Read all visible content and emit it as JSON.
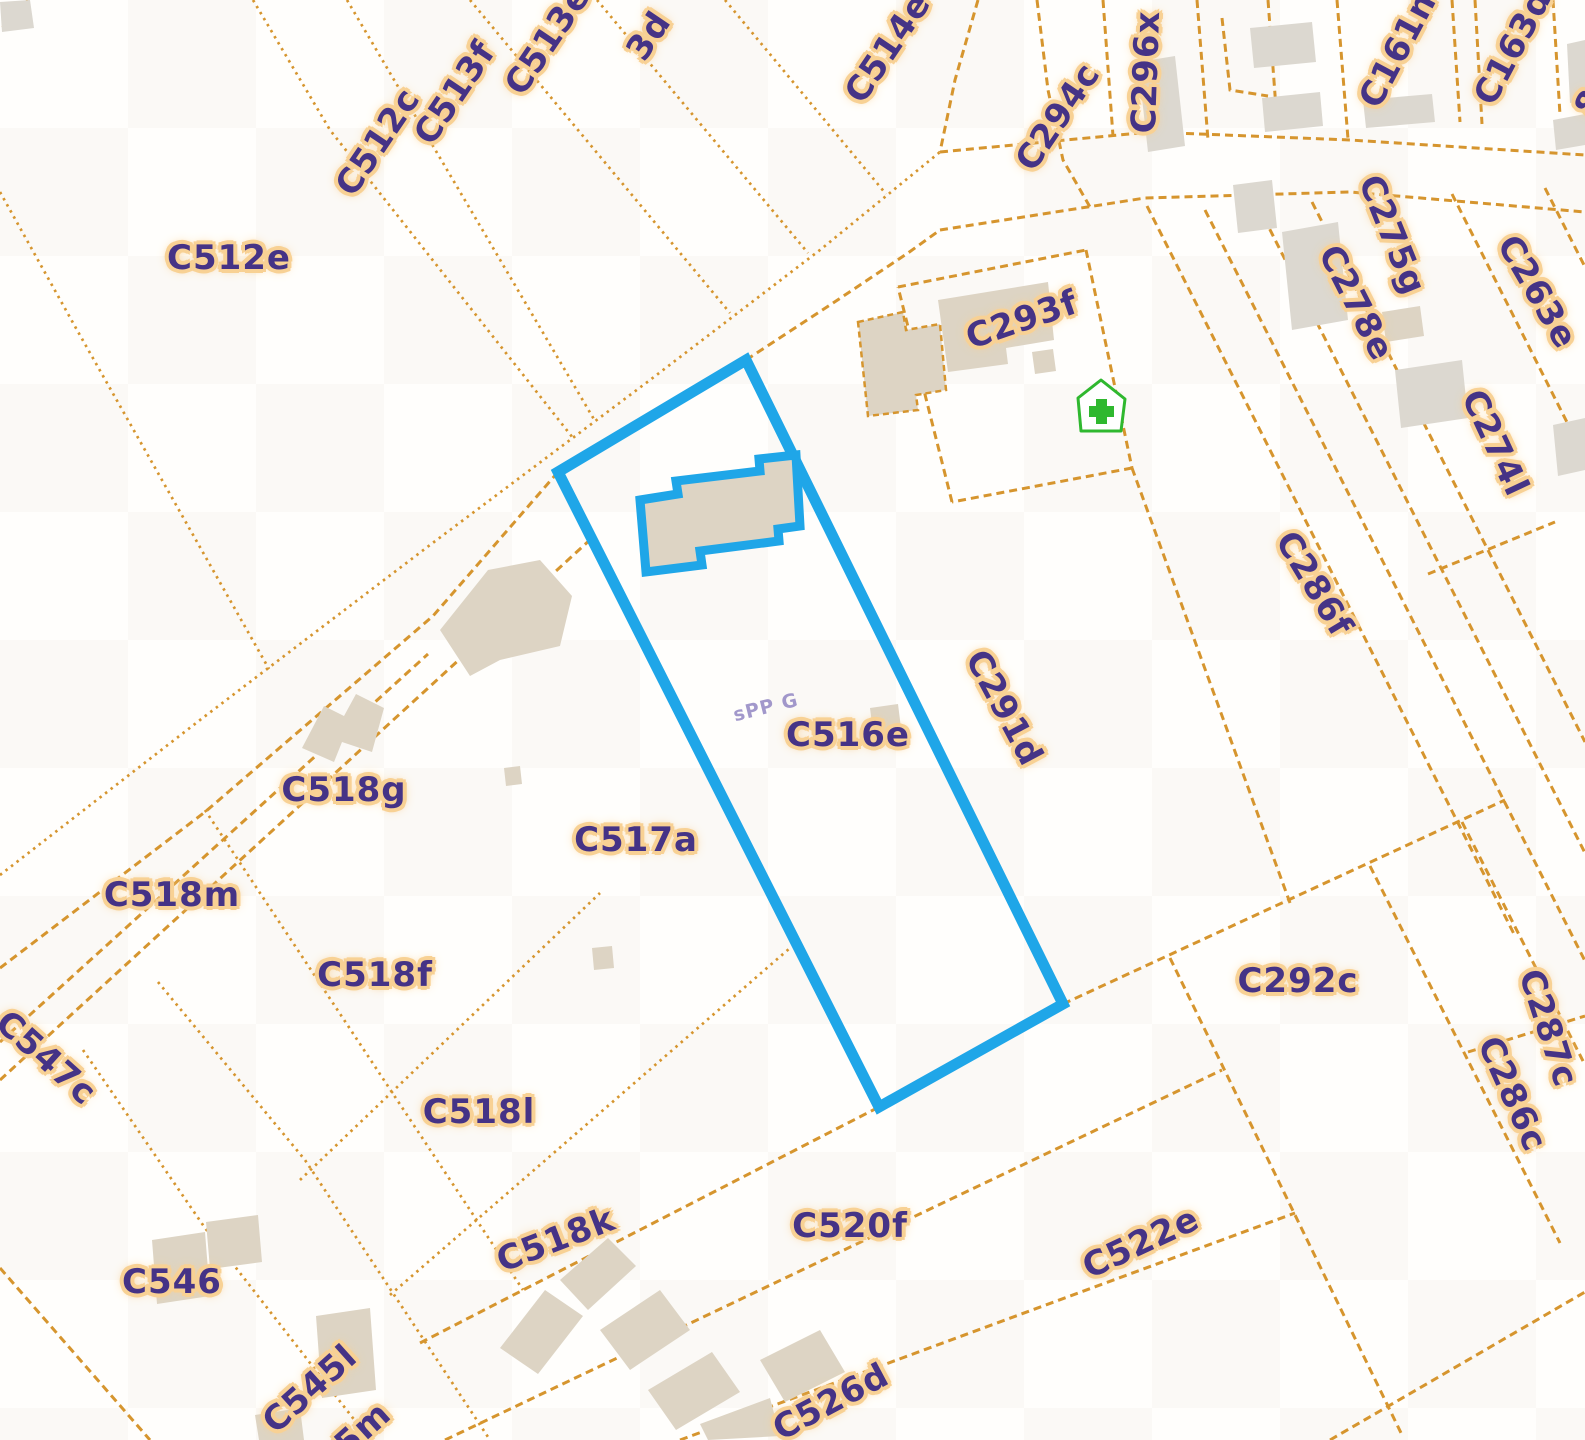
{
  "map": {
    "type": "cadastral-parcel-map",
    "canvas": {
      "width": 1585,
      "height": 1440
    },
    "colors": {
      "background": "#fffefc",
      "parcel_line": "#d6952e",
      "label_text": "#453386",
      "label_halo": "#f8d194",
      "highlight_blue": "#1fa6e8",
      "building_fill": "#ddd4c4",
      "building_fill_alt": "#dcd8d0",
      "poi_green": "#2fb82f",
      "faint_text": "#8b7fc0"
    },
    "selected_parcel": {
      "label": "C516e",
      "outline_points": "558,472 746,360 1063,1004 879,1107",
      "building_points": "640,500 678,494 676,481 760,471 759,459 796,455 800,526 778,529 779,541 700,551 702,565 646,572"
    },
    "poi_icon": {
      "name": "pharmacy-house-icon",
      "house_points": "1101,380 1125,399 1121,431 1081,431 1078,398",
      "cross_v": {
        "x": 1096,
        "y": 399,
        "w": 11,
        "h": 25
      },
      "cross_h": {
        "x": 1089,
        "y": 406,
        "w": 25,
        "h": 11
      }
    },
    "labels": [
      {
        "text": "C512e",
        "x": 229,
        "y": 258,
        "rot": 0
      },
      {
        "text": "C512c",
        "x": 378,
        "y": 142,
        "rot": -56
      },
      {
        "text": "C513f",
        "x": 455,
        "y": 93,
        "rot": -56
      },
      {
        "text": "C513e",
        "x": 548,
        "y": 40,
        "rot": -56
      },
      {
        "text": "3d",
        "x": 649,
        "y": 36,
        "rot": -56
      },
      {
        "text": "C514e",
        "x": 888,
        "y": 48,
        "rot": -56
      },
      {
        "text": "C294c",
        "x": 1058,
        "y": 117,
        "rot": -56
      },
      {
        "text": "C296x",
        "x": 1146,
        "y": 72,
        "rot": -88
      },
      {
        "text": "C161n",
        "x": 1398,
        "y": 50,
        "rot": -62
      },
      {
        "text": "C163d",
        "x": 1513,
        "y": 47,
        "rot": -62
      },
      {
        "text": "8",
        "x": 1590,
        "y": 103,
        "rot": -62
      },
      {
        "text": "C293f",
        "x": 1022,
        "y": 320,
        "rot": -19
      },
      {
        "text": "C275g",
        "x": 1392,
        "y": 235,
        "rot": 68
      },
      {
        "text": "C278e",
        "x": 1356,
        "y": 303,
        "rot": 63
      },
      {
        "text": "C263e",
        "x": 1537,
        "y": 292,
        "rot": 60
      },
      {
        "text": "C274l",
        "x": 1495,
        "y": 443,
        "rot": 65
      },
      {
        "text": "C286f",
        "x": 1314,
        "y": 584,
        "rot": 59
      },
      {
        "text": "C291d",
        "x": 1004,
        "y": 708,
        "rot": 62
      },
      {
        "text": "C516e",
        "x": 848,
        "y": 735,
        "rot": 0
      },
      {
        "text": "C517a",
        "x": 636,
        "y": 840,
        "rot": 0
      },
      {
        "text": "C518g",
        "x": 344,
        "y": 790,
        "rot": 0
      },
      {
        "text": "C518m",
        "x": 172,
        "y": 895,
        "rot": 0
      },
      {
        "text": "C518f",
        "x": 375,
        "y": 975,
        "rot": 0
      },
      {
        "text": "C547c",
        "x": 46,
        "y": 1058,
        "rot": 42
      },
      {
        "text": "C518l",
        "x": 479,
        "y": 1112,
        "rot": 0
      },
      {
        "text": "C518k",
        "x": 556,
        "y": 1240,
        "rot": -21
      },
      {
        "text": "C520f",
        "x": 850,
        "y": 1226,
        "rot": 0
      },
      {
        "text": "C292c",
        "x": 1298,
        "y": 981,
        "rot": 0
      },
      {
        "text": "C287c",
        "x": 1548,
        "y": 1028,
        "rot": 72
      },
      {
        "text": "C286c",
        "x": 1512,
        "y": 1094,
        "rot": 66
      },
      {
        "text": "C546",
        "x": 172,
        "y": 1282,
        "rot": 0
      },
      {
        "text": "C545l",
        "x": 310,
        "y": 1389,
        "rot": -42
      },
      {
        "text": "5m",
        "x": 363,
        "y": 1429,
        "rot": -42
      },
      {
        "text": "C526d",
        "x": 831,
        "y": 1402,
        "rot": -28
      },
      {
        "text": "C522e",
        "x": 1141,
        "y": 1243,
        "rot": -25
      }
    ],
    "faint_label": {
      "text": "sPP G",
      "x": 766,
      "y": 708,
      "rot": -14
    },
    "boundary_lines": [
      {
        "style": "dot",
        "points": [
          [
            28,
            0
          ],
          [
            0,
            30
          ]
        ]
      },
      {
        "style": "dot",
        "points": [
          [
            0,
            192
          ],
          [
            77,
            330
          ],
          [
            269,
            669
          ]
        ]
      },
      {
        "style": "dot",
        "points": [
          [
            253,
            0
          ],
          [
            330,
            130
          ],
          [
            573,
            438
          ]
        ]
      },
      {
        "style": "dot",
        "points": [
          [
            347,
            0
          ],
          [
            595,
            421
          ]
        ]
      },
      {
        "style": "dot",
        "points": [
          [
            470,
            0
          ],
          [
            730,
            313
          ]
        ]
      },
      {
        "style": "dot",
        "points": [
          [
            597,
            0
          ],
          [
            808,
            253
          ]
        ]
      },
      {
        "style": "dot",
        "points": [
          [
            725,
            0
          ],
          [
            886,
            194
          ]
        ]
      },
      {
        "style": "dot",
        "points": [
          [
            0,
            875
          ],
          [
            200,
            720
          ],
          [
            430,
            545
          ],
          [
            650,
            380
          ],
          [
            820,
            250
          ],
          [
            940,
            152
          ]
        ]
      },
      {
        "style": "dash",
        "points": [
          [
            0,
            968
          ],
          [
            205,
            812
          ],
          [
            433,
            616
          ],
          [
            558,
            472
          ]
        ]
      },
      {
        "style": "dash",
        "points": [
          [
            746,
            360
          ],
          [
            830,
            305
          ],
          [
            908,
            253
          ],
          [
            940,
            230
          ]
        ]
      },
      {
        "style": "dash",
        "points": [
          [
            978,
            0
          ],
          [
            955,
            80
          ],
          [
            940,
            152
          ]
        ]
      },
      {
        "style": "dash",
        "points": [
          [
            1037,
            0
          ],
          [
            1048,
            90
          ],
          [
            1063,
            160
          ],
          [
            1090,
            207
          ]
        ]
      },
      {
        "style": "dash",
        "points": [
          [
            1103,
            0
          ],
          [
            1113,
            136
          ]
        ]
      },
      {
        "style": "dash",
        "points": [
          [
            1197,
            0
          ],
          [
            1208,
            140
          ]
        ]
      },
      {
        "style": "dash",
        "points": [
          [
            1222,
            18
          ],
          [
            1230,
            90
          ],
          [
            1268,
            96
          ]
        ]
      },
      {
        "style": "dash",
        "points": [
          [
            1268,
            0
          ],
          [
            1276,
            108
          ]
        ]
      },
      {
        "style": "dash",
        "points": [
          [
            1337,
            0
          ],
          [
            1348,
            139
          ]
        ]
      },
      {
        "style": "dash",
        "points": [
          [
            1452,
            0
          ],
          [
            1460,
            122
          ]
        ]
      },
      {
        "style": "dash",
        "points": [
          [
            1475,
            0
          ],
          [
            1482,
            124
          ]
        ]
      },
      {
        "style": "dash",
        "points": [
          [
            1553,
            0
          ],
          [
            1560,
            115
          ]
        ]
      },
      {
        "style": "dash",
        "points": [
          [
            940,
            152
          ],
          [
            1150,
            132
          ],
          [
            1350,
            140
          ],
          [
            1585,
            155
          ]
        ]
      },
      {
        "style": "dash",
        "points": [
          [
            940,
            230
          ],
          [
            1145,
            198
          ],
          [
            1350,
            192
          ],
          [
            1585,
            212
          ]
        ]
      },
      {
        "style": "dash",
        "points": [
          [
            1147,
            206
          ],
          [
            1515,
            936
          ]
        ]
      },
      {
        "style": "dash",
        "points": [
          [
            1205,
            210
          ],
          [
            1585,
            961
          ]
        ]
      },
      {
        "style": "dash",
        "points": [
          [
            1258,
            206
          ],
          [
            1585,
            853
          ]
        ]
      },
      {
        "style": "dash",
        "points": [
          [
            1312,
            202
          ],
          [
            1585,
            742
          ]
        ]
      },
      {
        "style": "dash",
        "points": [
          [
            1452,
            194
          ],
          [
            1585,
            458
          ]
        ]
      },
      {
        "style": "dash",
        "points": [
          [
            1545,
            188
          ],
          [
            1585,
            267
          ]
        ]
      },
      {
        "style": "dash",
        "points": [
          [
            1428,
            574
          ],
          [
            1555,
            522
          ]
        ]
      },
      {
        "style": "dash",
        "points": [
          [
            1063,
            1004
          ],
          [
            1505,
            800
          ]
        ]
      },
      {
        "style": "dash",
        "points": [
          [
            1370,
            866
          ],
          [
            1560,
            1243
          ]
        ]
      },
      {
        "style": "dash",
        "points": [
          [
            1462,
            822
          ],
          [
            1585,
            1065
          ]
        ]
      },
      {
        "style": "dash",
        "points": [
          [
            1468,
            1052
          ],
          [
            1585,
            1016
          ]
        ]
      },
      {
        "style": "dash",
        "points": [
          [
            1170,
            958
          ],
          [
            1403,
            1437
          ]
        ]
      },
      {
        "style": "dash",
        "points": [
          [
            1330,
            1440
          ],
          [
            1585,
            1292
          ]
        ]
      },
      {
        "style": "dash",
        "points": [
          [
            898,
            287
          ],
          [
            1086,
            250
          ]
        ]
      },
      {
        "style": "dash",
        "points": [
          [
            1086,
            250
          ],
          [
            1132,
            468
          ]
        ]
      },
      {
        "style": "dash",
        "points": [
          [
            1132,
            468
          ],
          [
            952,
            502
          ]
        ]
      },
      {
        "style": "dash",
        "points": [
          [
            952,
            502
          ],
          [
            898,
            287
          ]
        ]
      },
      {
        "style": "dash",
        "points": [
          [
            1132,
            468
          ],
          [
            1290,
            903
          ]
        ]
      },
      {
        "style": "dash",
        "points": [
          [
            0,
            1042
          ],
          [
            428,
            654
          ]
        ]
      },
      {
        "style": "dash",
        "points": [
          [
            0,
            1080
          ],
          [
            592,
            538
          ]
        ]
      },
      {
        "style": "dot",
        "points": [
          [
            205,
            810
          ],
          [
            523,
            1290
          ]
        ]
      },
      {
        "style": "dot",
        "points": [
          [
            300,
            1180
          ],
          [
            600,
            893
          ]
        ]
      },
      {
        "style": "dot",
        "points": [
          [
            390,
            1295
          ],
          [
            790,
            948
          ]
        ]
      },
      {
        "style": "dash",
        "points": [
          [
            420,
            1343
          ],
          [
            879,
            1107
          ]
        ]
      },
      {
        "style": "dash",
        "points": [
          [
            445,
            1440
          ],
          [
            1222,
            1070
          ]
        ]
      },
      {
        "style": "dash",
        "points": [
          [
            680,
            1440
          ],
          [
            1295,
            1213
          ]
        ]
      },
      {
        "style": "dot",
        "points": [
          [
            83,
            1050
          ],
          [
            205,
            1228
          ],
          [
            370,
            1440
          ]
        ]
      },
      {
        "style": "dot",
        "points": [
          [
            158,
            982
          ],
          [
            305,
            1160
          ],
          [
            490,
            1440
          ]
        ]
      },
      {
        "style": "dash",
        "points": [
          [
            0,
            1268
          ],
          [
            150,
            1440
          ]
        ]
      }
    ],
    "buildings": [
      {
        "points": "858,322 903,312 906,330 940,324 946,390 916,395 918,410 868,416",
        "outlined": true
      },
      {
        "points": "938,300 1048,282 1054,340 1006,348 1008,364 948,372"
      },
      {
        "points": "1032,352 1053,349 1056,371 1035,374"
      },
      {
        "points": "1138,62 1175,56 1185,146 1148,152",
        "alt": true
      },
      {
        "points": "1250,28 1312,22 1316,62 1254,68",
        "alt": true
      },
      {
        "points": "1262,98 1320,92 1323,126 1265,132",
        "alt": true
      },
      {
        "points": "1363,100 1432,94 1435,122 1366,128",
        "alt": true
      },
      {
        "points": "1233,185 1272,180 1277,228 1238,233",
        "alt": true
      },
      {
        "points": "1567,44 1585,40 1585,100 1570,103",
        "alt": true
      },
      {
        "points": "1553,120 1585,114 1585,145 1556,150",
        "alt": true
      },
      {
        "points": "1282,232 1338,222 1348,320 1292,330",
        "alt": true
      },
      {
        "points": "1382,312 1420,306 1424,336 1386,342"
      },
      {
        "points": "1395,370 1462,360 1468,418 1401,428",
        "alt": true
      },
      {
        "points": "1553,425 1585,418 1585,470 1558,476",
        "alt": true
      },
      {
        "points": "870,708 898,704 902,736 874,740"
      },
      {
        "points": "440,630 488,570 540,560 572,596 560,646 500,660 470,676"
      },
      {
        "points": "302,748 324,706 344,716 356,694 384,708 372,752 342,742 334,762"
      },
      {
        "points": "504,768 520,766 522,784 506,786"
      },
      {
        "points": "592,948 612,946 614,968 594,970"
      },
      {
        "points": "152,1240 205,1232 210,1296 157,1304"
      },
      {
        "points": "206,1222 258,1215 262,1262 210,1269"
      },
      {
        "points": "316,1316 370,1308 376,1390 322,1398"
      },
      {
        "points": "500,1348 545,1290 583,1316 538,1374"
      },
      {
        "points": "560,1280 608,1238 636,1266 588,1310"
      },
      {
        "points": "600,1330 660,1290 690,1330 630,1370"
      },
      {
        "points": "648,1390 712,1352 740,1392 676,1430"
      },
      {
        "points": "760,1360 820,1330 845,1372 785,1402"
      },
      {
        "points": "700,1424 770,1398 780,1436 708,1440"
      },
      {
        "points": "255,1415 300,1408 304,1440 259,1440"
      },
      {
        "points": "0,2 30,0 34,28 2,32",
        "alt": true
      }
    ]
  }
}
